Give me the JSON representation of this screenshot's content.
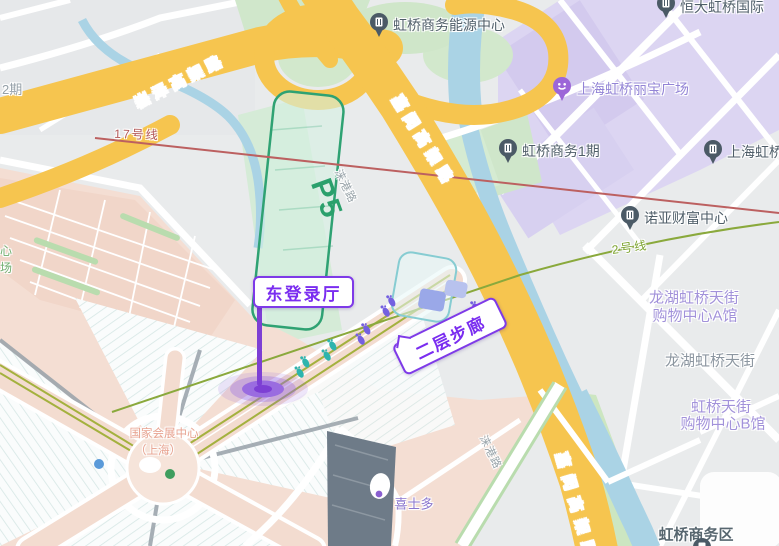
{
  "map_labels": {
    "songze_elevated": "崧泽高架路",
    "jiamin_elevated_top": "嘉闵高架路",
    "jiamin_elevated_bottom": "嘉闵高架路",
    "laigang_road_top": "涞港路",
    "laigang_road_bottom": "涞港路",
    "line17": "17号线",
    "line2": "2号线",
    "phase2_fragment": "2期",
    "green_fragment_1": "心",
    "green_fragment_2": "场",
    "p5_parking": "P5",
    "necc_line1": "国家会展中心",
    "necc_line2": "（上海）",
    "cstore": "喜士多",
    "hongqiao_business_district": "虹桥商务区",
    "longhu_tianjie_a_line1": "龙湖虹桥天街",
    "longhu_tianjie_a_line2": "购物中心A馆",
    "longhu_tianjie_gray": "龙湖虹桥天街",
    "tianjie_b_line1": "虹桥天街",
    "tianjie_b_line2": "购物中心B馆"
  },
  "pois": {
    "energy_center": "虹桥商务能源中心",
    "hengda_international": "恒大虹桥国际",
    "libao_plaza": "上海虹桥丽宝广场",
    "biz_phase1": "虹桥商务1期",
    "shanghai_hongqiao": "上海虹桥",
    "noah_wealth_center": "诺亚财富中心"
  },
  "callouts": {
    "east_login_hall": "东登录厅",
    "second_floor_walkway": "二层步廊"
  },
  "colors": {
    "highway_yellow": "#f6c54f",
    "water_blue": "#aad3e5",
    "park_green": "#d2e8cc",
    "lavender_district": "#dcd5f2",
    "salmon_venue": "#f4ded3",
    "callout_purple": "#7a2df0",
    "marker_purple": "#9a6ce0",
    "line2_green": "#8aa93c",
    "line17_red": "#bc6060",
    "p5_green": "#2aa06c"
  }
}
